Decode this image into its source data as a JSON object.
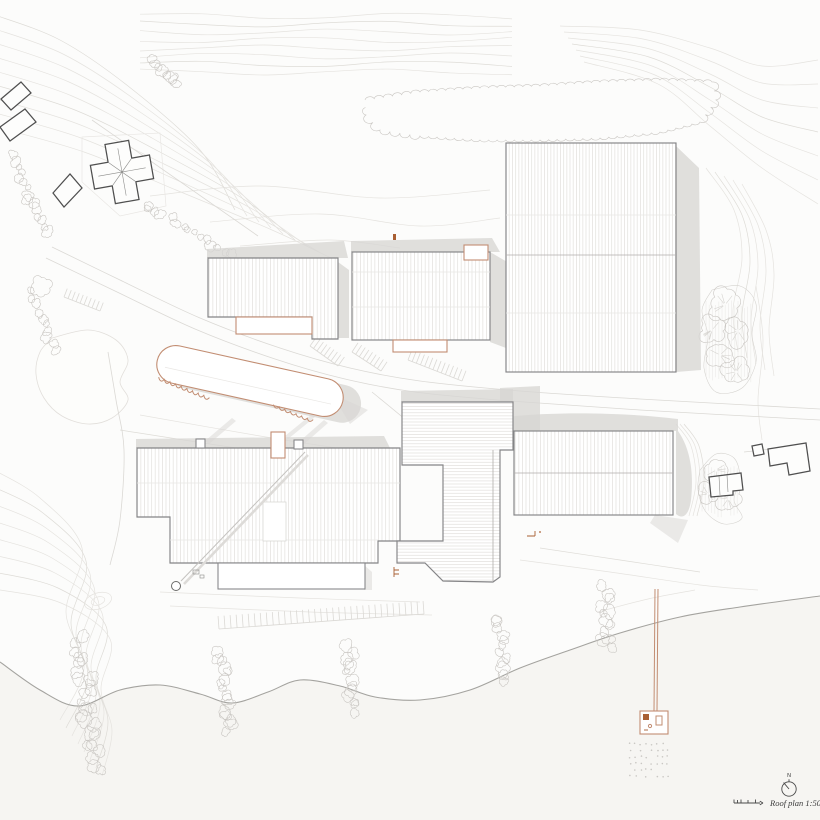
{
  "annotations": {
    "north_label": "N",
    "caption": "Roof plan 1:500"
  },
  "colors": {
    "bg": "#fcfcfb",
    "beach": "#f6f5f2",
    "contour": "#e5e3df",
    "road": "#dbd9d5",
    "bldOutline": "#848486",
    "existOutline": "#4f4f4f",
    "hatch": "#e2e0dd",
    "shadow": "#d7d6d3",
    "accent": "#c28d72",
    "accentDark": "#a95f33",
    "shoreline": "#a4a39f",
    "ink": "#4a4a4a",
    "veg": "#c9c6c2"
  },
  "elements": {
    "drawing": "architectural roof plan with contour lines, shoreline and pier",
    "icons": [
      "north-arrow-icon",
      "scale-bar-icon"
    ],
    "building_groups": [
      "hall-northwest",
      "hall-center-north",
      "large-hall-northeast",
      "canopy-oval",
      "complex-southwest",
      "building-center-tall",
      "hall-southeast",
      "existing-houses-northwest",
      "existing-houses-east"
    ],
    "site_features": [
      "roads",
      "parking-rows",
      "vegetation-band",
      "tree-clusters",
      "shore-shrubs",
      "shoreline",
      "beach",
      "pier",
      "pier-platform",
      "water-post-dots"
    ]
  }
}
